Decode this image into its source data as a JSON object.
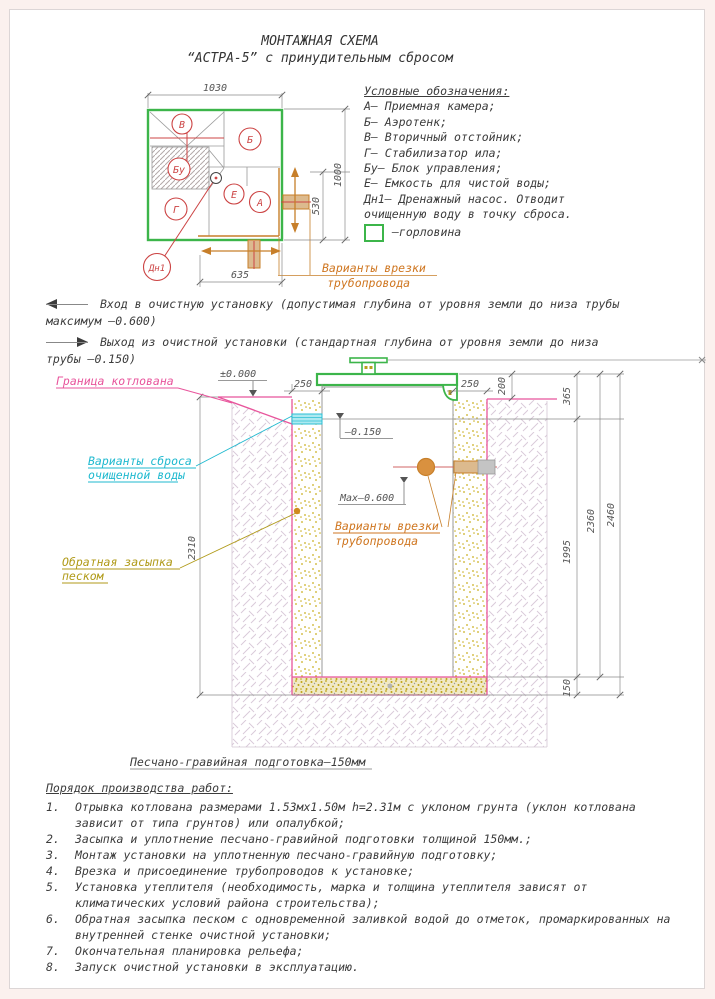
{
  "title": {
    "line1": "МОНТАЖНАЯ СХЕМА",
    "line2": "“АСТРА-5” с принудительным сбросом"
  },
  "legend": {
    "heading": "Условные обозначения:",
    "items": [
      "А– Приемная камера;",
      "Б– Аэротенк;",
      "В– Вторичный отстойник;",
      "Г– Стабилизатор ила;",
      "Бу– Блок управления;",
      "Е– Емкость для чистой воды;",
      "Дн1– Дренажный насос. Отводит",
      "очищенную воду в точку сброса."
    ],
    "neck_label": "–горловина"
  },
  "notes": {
    "inlet_line1": "Вход в очистную установку (допустимая глубина от уровня земли до низа трубы",
    "inlet_line2": "максимум –0.600)",
    "outlet_line1": "Выход из очистной установки (стандартная глубина от уровня земли до низа",
    "outlet_line2": "трубы –0.150)"
  },
  "plan": {
    "dim_width": "1030",
    "dim_height": "1000",
    "dim_530": "530",
    "dim_635": "635",
    "labels": {
      "v": "В",
      "b": "Б",
      "bu": "Бу",
      "e": "Е",
      "a": "А",
      "g": "Г",
      "dn1": "Дн1"
    },
    "pipe_note_line1": "Варианты врезки",
    "pipe_note_line2": "трубопровода"
  },
  "section": {
    "pit_boundary": "Граница котлована",
    "discharge_line1": "Варианты сброса",
    "discharge_line2": "очищенной воды",
    "backfill_line1": "Обратная засыпка",
    "backfill_line2": "песком",
    "pipe_note_line1": "Варианты врезки",
    "pipe_note_line2": "трубопровода",
    "base_note": "Песчано-гравийная подготовка–150мм",
    "level_zero": "±0.000",
    "level_outlet": "–0.150",
    "level_inlet": "Max–0.600",
    "dim_250_left": "250",
    "dim_250_right": "250",
    "dim_200": "200",
    "dim_365": "365",
    "dim_1995": "1995",
    "dim_2360": "2360",
    "dim_2460": "2460",
    "dim_150": "150",
    "dim_2310": "2310"
  },
  "procedure": {
    "heading": "Порядок производства работ:",
    "items": [
      {
        "n": "1.",
        "lines": [
          "Отрывка котлована размерами 1.53мх1.50м h=2.31м с уклоном грунта (уклон котлована",
          "зависит от типа грунтов) или опалубкой;"
        ]
      },
      {
        "n": "2.",
        "lines": [
          "Засыпка и уплотнение песчано-гравийной подготовки толщиной 150мм.;"
        ]
      },
      {
        "n": "3.",
        "lines": [
          "Монтаж установки на уплотненную песчано-гравийную подготовку;"
        ]
      },
      {
        "n": "4.",
        "lines": [
          "Врезка и присоединение трубопроводов к установке;"
        ]
      },
      {
        "n": "5.",
        "lines": [
          "Установка утеплителя (необходимость, марка и толщина утеплителя зависят от",
          "климатических условий района строительства);"
        ]
      },
      {
        "n": "6.",
        "lines": [
          "Обратная засыпка песком с одновременной заливкой водой до отметок, промаркированных на",
          "внутренней стенке очистной установки;"
        ]
      },
      {
        "n": "7.",
        "lines": [
          "Окончательная планировка рельефа;"
        ]
      },
      {
        "n": "8.",
        "lines": [
          "Запуск очистной установки в эксплуатацию."
        ]
      }
    ]
  },
  "colors": {
    "green": "#3cb54a",
    "pink": "#e8559c",
    "cyan": "#1fb9cf",
    "orange": "#cf7620",
    "tan": "#dcba8e",
    "sand_dot": "#c9ad1e",
    "red": "#cc4444"
  }
}
